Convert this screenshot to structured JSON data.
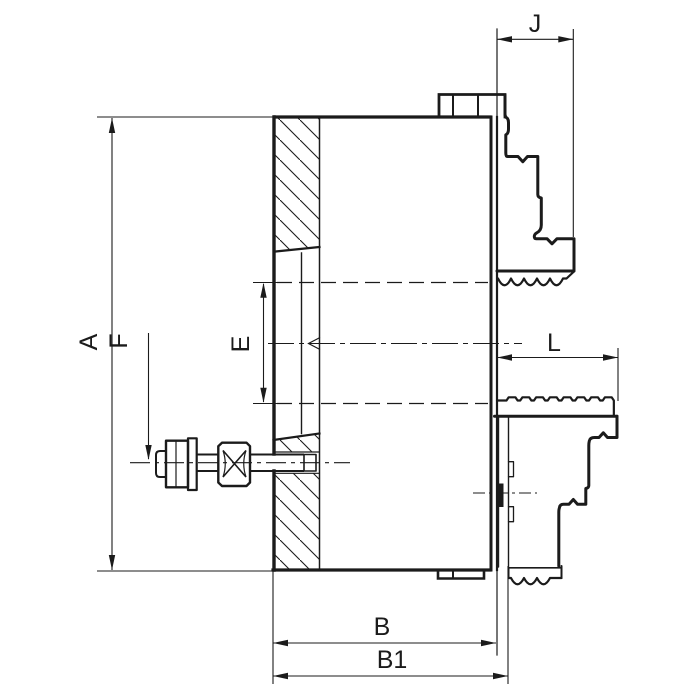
{
  "drawing": {
    "type": "lathe-chuck-sectional-drawing",
    "labels": {
      "a": "A",
      "f": "F",
      "e": "E",
      "j": "J",
      "l": "L",
      "b": "B",
      "b1": "B1"
    },
    "colors": {
      "line": "#1b1b1b",
      "background": "#ffffff"
    }
  }
}
